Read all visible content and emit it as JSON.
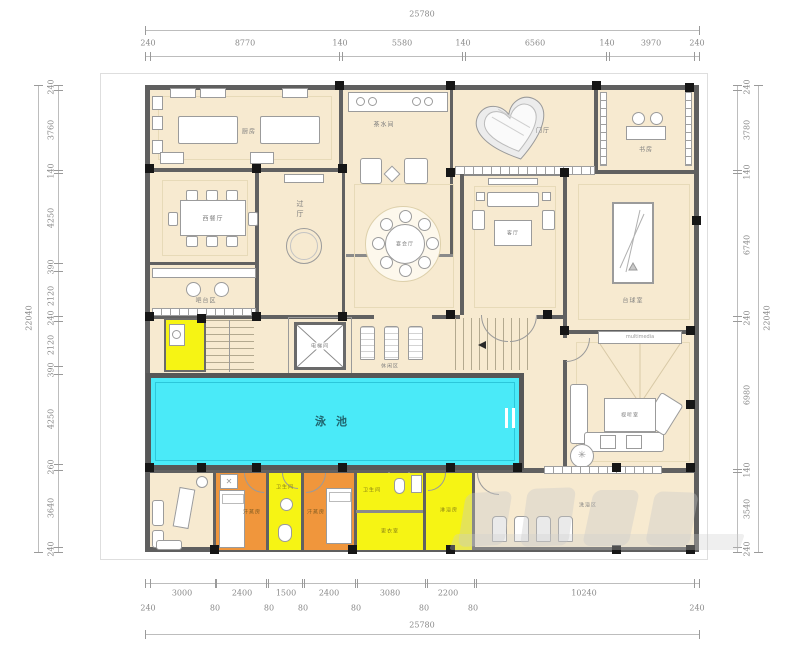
{
  "dimensions": {
    "top": {
      "total": "25780",
      "segments": [
        "240",
        "8770",
        "140",
        "5580",
        "140",
        "6560",
        "140",
        "3970",
        "240"
      ]
    },
    "left": {
      "total": "22040",
      "segments": [
        "240",
        "3760",
        "140",
        "4250",
        "390",
        "2120",
        "240",
        "2120",
        "390",
        "4250",
        "260",
        "3640",
        "240"
      ]
    },
    "right": {
      "total": "22040",
      "segments": [
        "240",
        "3780",
        "140",
        "6740",
        "240",
        "6980",
        "140",
        "3540",
        "240"
      ]
    },
    "bottom": {
      "total": "25780",
      "rooms": [
        "3000",
        "2400",
        "1500",
        "2400",
        "3080",
        "2200",
        "10240"
      ],
      "walls": [
        "240",
        "80",
        "80",
        "80",
        "80",
        "80",
        "80",
        "240"
      ]
    }
  },
  "rooms": {
    "kitchen": {
      "label": "厨房"
    },
    "pantry": {
      "label": "茶水间"
    },
    "foyer": {
      "label": "门厅"
    },
    "study": {
      "label": "书房"
    },
    "west_dining": {
      "label": "西餐厅"
    },
    "passage": {
      "label": "过厅"
    },
    "banquet": {
      "label": "宴会厅"
    },
    "living": {
      "label": "客厅"
    },
    "billiards": {
      "label": "台球室"
    },
    "bar": {
      "label": "吧台区"
    },
    "elevator": {
      "label": "电梯间"
    },
    "lounge": {
      "label": "休闲区"
    },
    "pool": {
      "label": "泳池"
    },
    "theater": {
      "label": "视听室",
      "screen": "multimedia"
    },
    "sauna_left": {
      "label": "汗蒸房"
    },
    "bath_mid": {
      "label": "卫生间"
    },
    "sauna_right": {
      "label": "汗蒸房"
    },
    "wc": {
      "label": "卫生间"
    },
    "locker": {
      "label": "更衣室"
    },
    "shower": {
      "label": "淋浴房"
    },
    "bathing": {
      "label": "洗浴区"
    }
  },
  "colors": {
    "floor": "#f7ead0",
    "wall": "#616161",
    "pool_water": "#4AEAF8",
    "highlight_yellow": "#f6f414",
    "highlight_orange": "#f0963c",
    "column": "#161616",
    "dim_text": "#8a8a8a"
  },
  "watermark": {
    "present": true,
    "style": "translucent-gray"
  }
}
